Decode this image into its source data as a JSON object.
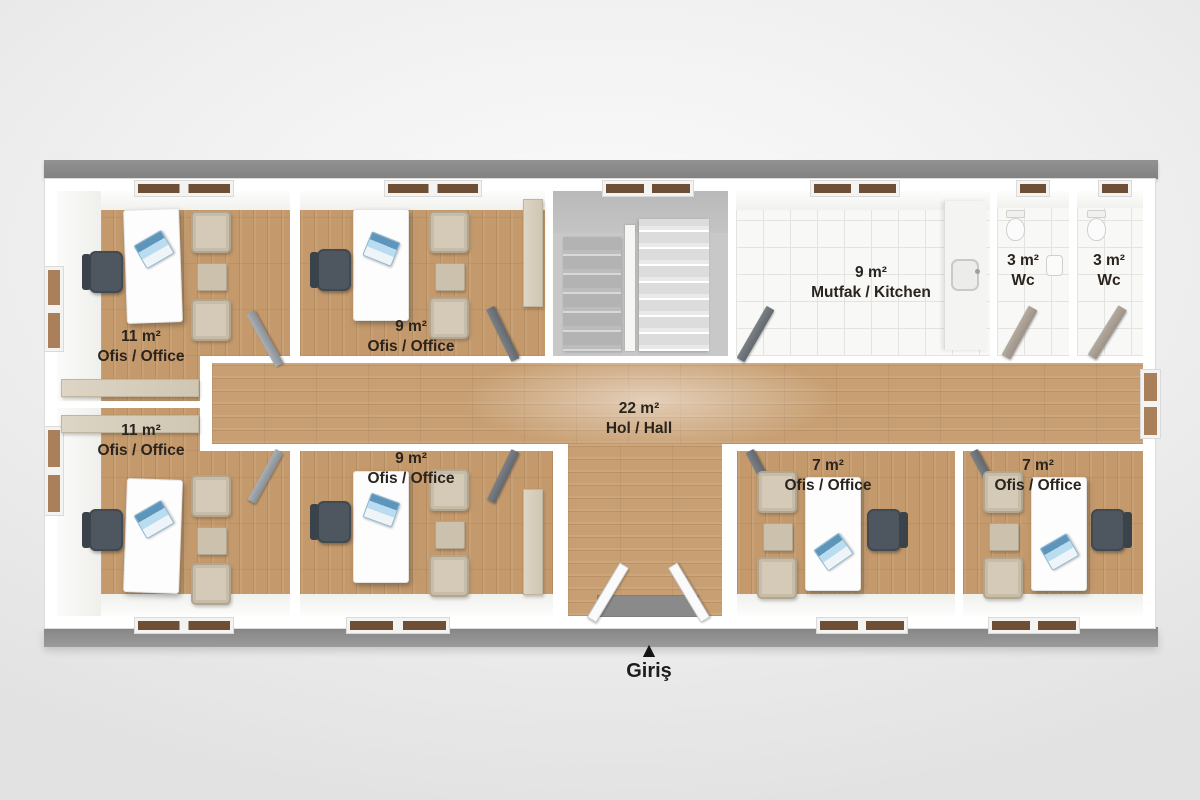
{
  "plan_title": "Office container floor plan",
  "entrance": {
    "label": "Giriş",
    "marker": "▲"
  },
  "rooms": [
    {
      "id": "office-top-left",
      "area": "11 m²",
      "label": "Ofis / Office"
    },
    {
      "id": "office-top-middle",
      "area": "9 m²",
      "label": "Ofis / Office"
    },
    {
      "id": "kitchen",
      "area": "9 m²",
      "label": "Mutfak / Kitchen"
    },
    {
      "id": "wc-left",
      "area": "3 m²",
      "label": "Wc"
    },
    {
      "id": "wc-right",
      "area": "3 m²",
      "label": "Wc"
    },
    {
      "id": "hall",
      "area": "22 m²",
      "label": "Hol / Hall"
    },
    {
      "id": "office-bottom-left",
      "area": "11 m²",
      "label": "Ofis / Office"
    },
    {
      "id": "office-bottom-middle",
      "area": "9 m²",
      "label": "Ofis / Office"
    },
    {
      "id": "office-bottom-right-1",
      "area": "7 m²",
      "label": "Ofis / Office"
    },
    {
      "id": "office-bottom-right-2",
      "area": "7 m²",
      "label": "Ofis / Office"
    }
  ],
  "colors": {
    "background": "#ececec",
    "frame_gray": "#8a8a8a",
    "wall_white": "#ffffff",
    "wood_floor": "#c49a6c",
    "tile_floor": "#f8f8f6",
    "stair_gray": "#c8c8c8",
    "label_text": "#2b241d",
    "chair_dark": "#4e575f",
    "furniture_beige": "#d4cab7",
    "laptop_blue": "#b9dcf0"
  }
}
